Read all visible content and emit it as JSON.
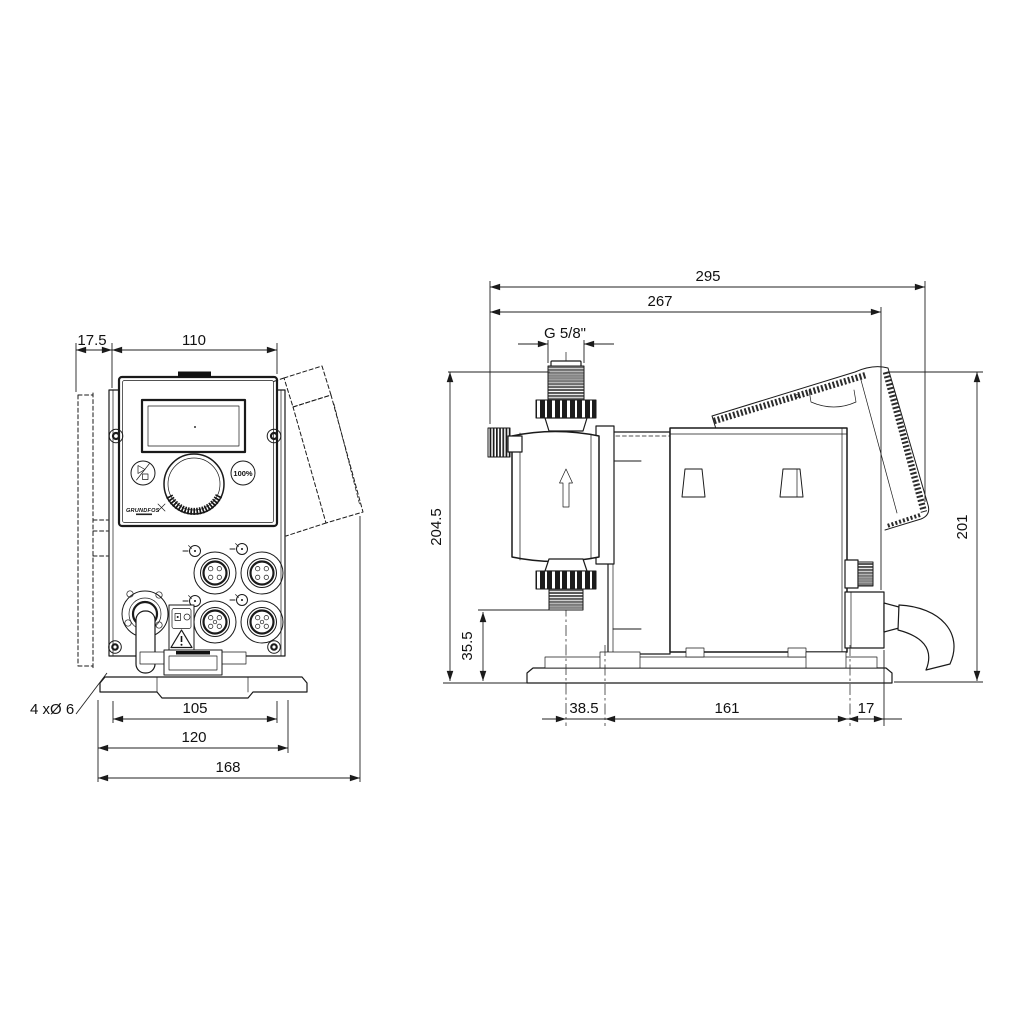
{
  "colors": {
    "line": "#1a1a1a",
    "dim": "#222222",
    "background": "#ffffff"
  },
  "front_view": {
    "dimensions": {
      "bracket_depth": "17.5",
      "body_width": "110",
      "hole_spacing": "105",
      "plate_width": "120",
      "overall_width": "168",
      "mounting_holes": "4 xØ 6"
    },
    "panel": {
      "logo": "GRUNDFOS",
      "button_100": "100%"
    }
  },
  "side_view": {
    "dimensions": {
      "overall_depth": "295",
      "depth_to_module": "267",
      "thread": "G 5/8\"",
      "height_to_port_top": "204.5",
      "height_to_port_bottom": "35.5",
      "overall_height": "201",
      "head_to_slot": "38.5",
      "slot_spacing": "161",
      "slot_to_edge": "17"
    }
  }
}
